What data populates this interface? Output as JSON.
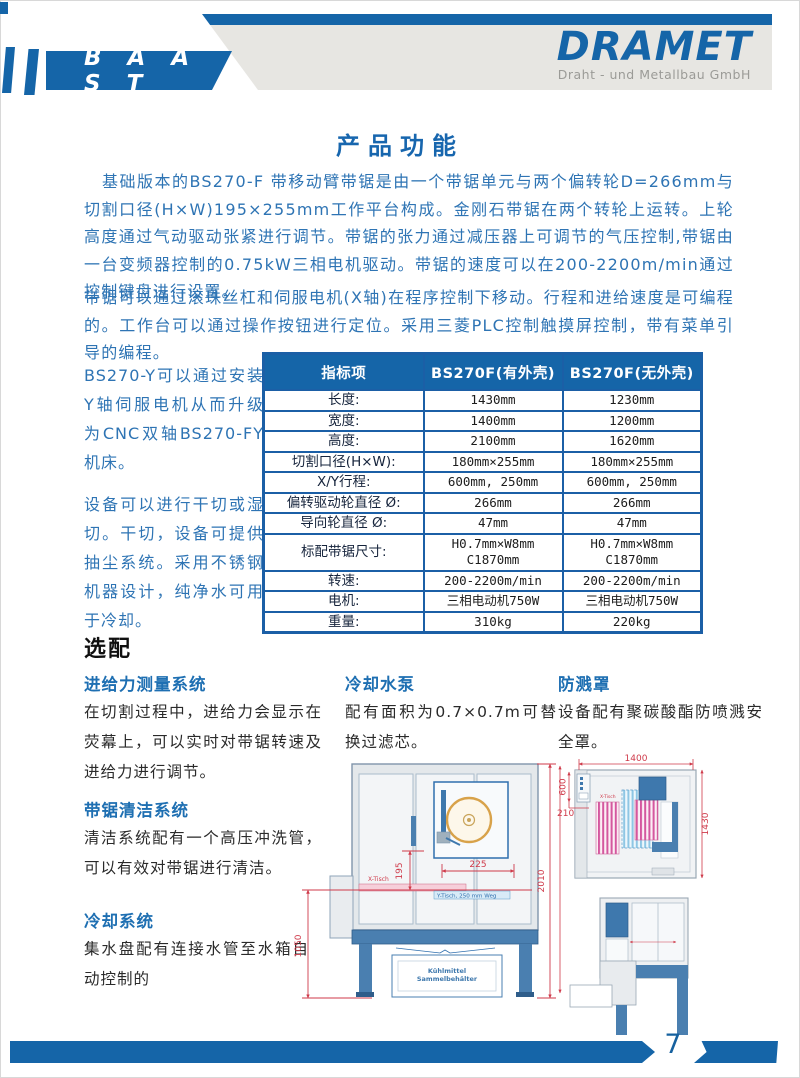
{
  "header": {
    "brand_left": "B A A S T",
    "brand_right": "DRAMET",
    "brand_right_subtitle": "Draht - und Metallbau GmbH"
  },
  "content": {
    "title": "产品功能",
    "paragraph_1": "基础版本的BS270-F 带移动臂带锯是由一个带锯单元与两个偏转轮D=266mm与切割口径(H×W)195×255mm工作平台构成。金刚石带锯在两个转轮上运转。上轮高度通过气动驱动张紧进行调节。带锯的张力通过减压器上可调节的气压控制,带锯由一台变频器控制的0.75kW三相电机驱动。带锯的速度可以在200-2200m/min通过控制键盘进行设置。",
    "paragraph_2": "带锯可以通过滚珠丝杠和伺服电机(X轴)在程序控制下移动。行程和进给速度是可编程的。工作台可以通过操作按钮进行定位。采用三菱PLC控制触摸屏控制，带有菜单引导的编程。",
    "side_paragraph_1": "BS270-Y可以通过安装Y轴伺服电机从而升级为CNC双轴BS270-FY机床。",
    "side_paragraph_2": "设备可以进行干切或湿切。干切，设备可提供抽尘系统。采用不锈钢机器设计，纯净水可用于冷却。"
  },
  "spec_table": {
    "headers": [
      "指标项",
      "BS270F(有外壳)",
      "BS270F(无外壳)"
    ],
    "rows": [
      {
        "label": "长度:",
        "with_housing": "1430mm",
        "without_housing": "1230mm"
      },
      {
        "label": "宽度:",
        "with_housing": "1400mm",
        "without_housing": "1200mm"
      },
      {
        "label": "高度:",
        "with_housing": "2100mm",
        "without_housing": "1620mm"
      },
      {
        "label": "切割口径(H×W):",
        "with_housing": "180mm×255mm",
        "without_housing": "180mm×255mm"
      },
      {
        "label": "X/Y行程:",
        "with_housing": "600mm, 250mm",
        "without_housing": "600mm, 250mm"
      },
      {
        "label": "偏转驱动轮直径 Ø:",
        "with_housing": "266mm",
        "without_housing": "266mm"
      },
      {
        "label": "导向轮直径 Ø:",
        "with_housing": "47mm",
        "without_housing": "47mm"
      },
      {
        "label": "标配带锯尺寸:",
        "with_housing": "H0.7mm×W8mm\nC1870mm",
        "without_housing": "H0.7mm×W8mm\nC1870mm"
      },
      {
        "label": "转速:",
        "with_housing": "200-2200m/min",
        "without_housing": "200-2200m/min"
      },
      {
        "label": "电机:",
        "with_housing": "三相电动机750W",
        "without_housing": "三相电动机750W"
      },
      {
        "label": "重量:",
        "with_housing": "310kg",
        "without_housing": "220kg"
      }
    ]
  },
  "options": {
    "heading": "选配",
    "feed_force": {
      "title": "进给力测量系统",
      "body": "在切割过程中，进给力会显示在荧幕上，可以实时对带锯转速及进给力进行调节。"
    },
    "cleaning": {
      "title": "带锯清洁系统",
      "body": "清洁系统配有一个高压冲洗管，可以有效对带锯进行清洁。"
    },
    "cooling_system": {
      "title": "冷却系统",
      "body": "集水盘配有连接水管至水箱自动控制的"
    },
    "cooling_pump": {
      "title": "冷却水泵",
      "body": "配有面积为0.7×0.7m可替换过滤芯。"
    },
    "splash_guard": {
      "title": "防溅罩",
      "body": "设备配有聚碳酸酯防喷溅安全罩。"
    }
  },
  "drawings": {
    "front_view": {
      "dim_195": "195",
      "dim_225": "225",
      "dim_1050": "1050",
      "dim_2010": "2010",
      "label_x_table": "X-Tisch",
      "label_y_table": "Y-Tisch, 250 mm Weg",
      "label_coolant_line1": "Kühlmittel",
      "label_coolant_line2": "Sammelbehälter"
    },
    "top_view": {
      "dim_1400": "1400",
      "dim_600": "600",
      "dim_210": "210",
      "dim_1430": "1430",
      "label_x_table": "X-Tisch"
    }
  },
  "footer": {
    "page_number": "7"
  },
  "colors": {
    "brand_blue": "#1565a8",
    "text_blue": "#2e74b4",
    "dim_red": "#cf3a4a",
    "wheel_orange": "#d8a24a"
  }
}
